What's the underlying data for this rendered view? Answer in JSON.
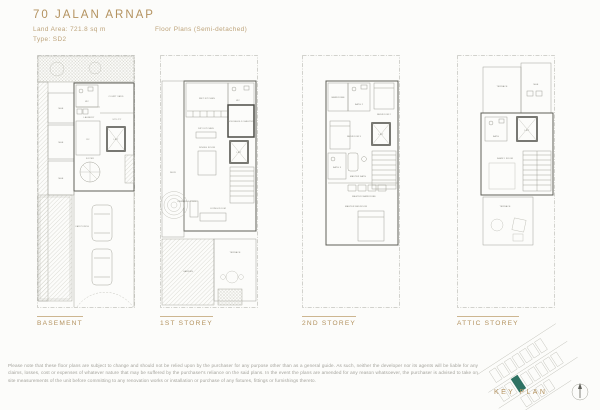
{
  "header": {
    "title": "70 JALAN ARNAP",
    "land_area": "Land Area: 721.8 sq m",
    "type": "Type: SD2",
    "subtitle": "Floor Plans (Semi-detached)"
  },
  "plans": [
    {
      "label": "BASEMENT",
      "rooms": {
        "wc": "WC",
        "courtyard": "COURT YARD",
        "laundry": "LAUNDRY",
        "utility": "UTILITY",
        "me1": "M&E",
        "me2": "M&E",
        "me3": "M&E",
        "rc": "RC",
        "lift": "LIFT",
        "foyer": "FOYER",
        "carporch": "CAR PORCH"
      }
    },
    {
      "label": "1ST STOREY",
      "rooms": {
        "wetkitchen": "WET KITCHEN",
        "wc": "WC",
        "shelter": "HOUSEHOLD SHELTER",
        "drykitchen": "DRY KITCHEN",
        "dining": "DINING ROOM",
        "lift": "LIFT",
        "living": "LIVING ROOM",
        "deck": "DECK",
        "pool": "SWIMMING POOL",
        "garden": "GARDEN",
        "terrace": "TERRACE"
      }
    },
    {
      "label": "2ND STOREY",
      "rooms": {
        "wardrobe": "WARDROBE",
        "bath2": "BATH 2",
        "bedroom2": "BEDROOM 2",
        "bedroom3": "BEDROOM 3",
        "bath3": "BATH 3",
        "lift": "LIFT",
        "masterbath": "MASTER BATH",
        "masterwardrobe": "MASTER WARDROBE",
        "masterbedroom": "MASTER BEDROOM"
      }
    },
    {
      "label": "ATTIC STOREY",
      "rooms": {
        "terrace1": "TERRACE",
        "me": "M&E",
        "bath": "BATH",
        "lift": "LIFT",
        "family": "FAMILY ROOM",
        "terrace2": "TERRACE"
      }
    }
  ],
  "footer": {
    "disclaimer": "Please note that these floor plans are subject to change and should not be relied upon by the purchaser for any purpose other than as a general guide. As such, neither the developer nor its agents will be liable for any claims, losses, cost or expenses of whatever nature that may be suffered by the purchaser's reliance on the said plans. In the event the plans are amended for any reason whatsoever, the purchaser is advised to take on site measurements of the unit before committing to any renovation works or installation or purchase of any fixtures, fittings or furnishings thereto.",
    "key_plan_label": "KEY PLAN"
  },
  "colors": {
    "accent_gold": "#b3925f",
    "plan_line": "#98988f",
    "wall": "#5f5f58",
    "highlight_green": "#2e7263",
    "text_gray": "#a3a29b"
  }
}
